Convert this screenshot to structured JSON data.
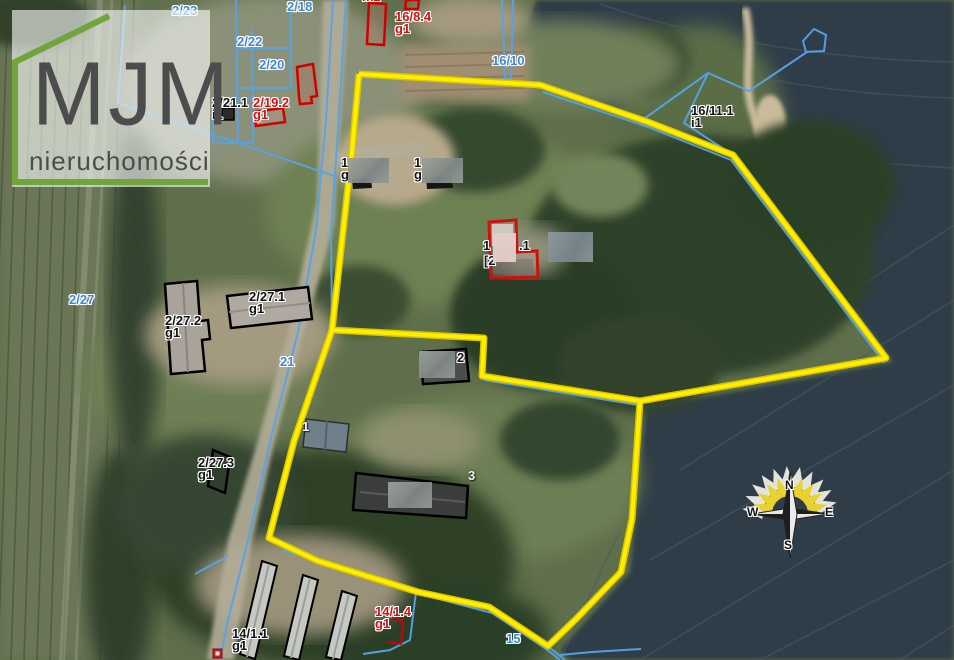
{
  "logo": {
    "title": "MJM",
    "subtitle": "nieruchomości"
  },
  "compass": {
    "north": "N",
    "east": "E",
    "south": "S",
    "west": "W"
  },
  "colors": {
    "boundary_yellow": "#ffe600",
    "parcel_line_blue": "#57a3e8",
    "building_outline_red": "#d10000",
    "building_outline_black": "#000000",
    "label_blue": "#3f88d4",
    "label_red": "#d40f0f",
    "label_black": "#141414",
    "logo_green": "#72a43c"
  },
  "map": {
    "labels": [
      {
        "id": "2-23",
        "text": "2/23",
        "color": "blue",
        "x": 172,
        "y": 5
      },
      {
        "id": "2-18",
        "text": "2/18",
        "color": "blue",
        "x": 287,
        "y": 1
      },
      {
        "id": "2-22",
        "text": "2/22",
        "color": "blue",
        "x": 237,
        "y": 36
      },
      {
        "id": "2-20",
        "text": "2/20",
        "color": "blue",
        "x": 259,
        "y": 59
      },
      {
        "id": "16-10",
        "text": "16/10",
        "color": "blue",
        "x": 492,
        "y": 55
      },
      {
        "id": "2-27",
        "text": "2/27",
        "color": "blue",
        "x": 69,
        "y": 294
      },
      {
        "id": "21",
        "text": "21",
        "color": "blue",
        "x": 280,
        "y": 356
      },
      {
        "id": "15",
        "text": "15",
        "color": "blue",
        "x": 506,
        "y": 633
      },
      {
        "id": "16-8-4",
        "text": "16/8.4\ng1",
        "color": "red",
        "x": 395,
        "y": 11
      },
      {
        "id": "2-19-2",
        "text": "2/19.2\ng1",
        "color": "red",
        "x": 253,
        "y": 97
      },
      {
        "id": "14-1-4",
        "text": "14/1.4\ng1",
        "color": "red",
        "x": 375,
        "y": 606
      },
      {
        "id": "clipped-top",
        "text": "m2",
        "color": "red",
        "x": 362,
        "y": -9
      },
      {
        "id": "2-21-1",
        "text": "2/21.1\ni1",
        "color": "black",
        "x": 212,
        "y": 97
      },
      {
        "id": "16-11-1",
        "text": "16/11.1\ni1",
        "color": "black",
        "x": 691,
        "y": 105
      },
      {
        "id": "2-27-2",
        "text": "2/27.2\ng1",
        "color": "black",
        "x": 165,
        "y": 315
      },
      {
        "id": "2-27-1",
        "text": "2/27.1\ng1",
        "color": "black",
        "x": 249,
        "y": 291
      },
      {
        "id": "2-27-3",
        "text": "2/27.3\ng1",
        "color": "black",
        "x": 198,
        "y": 457
      },
      {
        "id": "14-1-1",
        "text": "14/1.1\ng1",
        "color": "black",
        "x": 232,
        "y": 628
      },
      {
        "id": "bld-1a",
        "text": "1\ng",
        "color": "black",
        "x": 341,
        "y": 157
      },
      {
        "id": "bld-1b",
        "text": "1\ng1",
        "color": "black",
        "x": 414,
        "y": 157
      },
      {
        "id": "bld-c1",
        "text": "1",
        "color": "black",
        "x": 483,
        "y": 240
      },
      {
        "id": "bld-c2",
        "text": ".1",
        "color": "black",
        "x": 519,
        "y": 240
      },
      {
        "id": "bld-c3",
        "text": "[2",
        "color": "black",
        "x": 484,
        "y": 255
      },
      {
        "id": "bld-2",
        "text": "2",
        "color": "black",
        "x": 457,
        "y": 352
      },
      {
        "id": "bld-3",
        "text": "3",
        "color": "white",
        "x": 468,
        "y": 470
      },
      {
        "id": "bld-w1",
        "text": "1",
        "color": "white",
        "x": 302,
        "y": 421
      }
    ]
  }
}
